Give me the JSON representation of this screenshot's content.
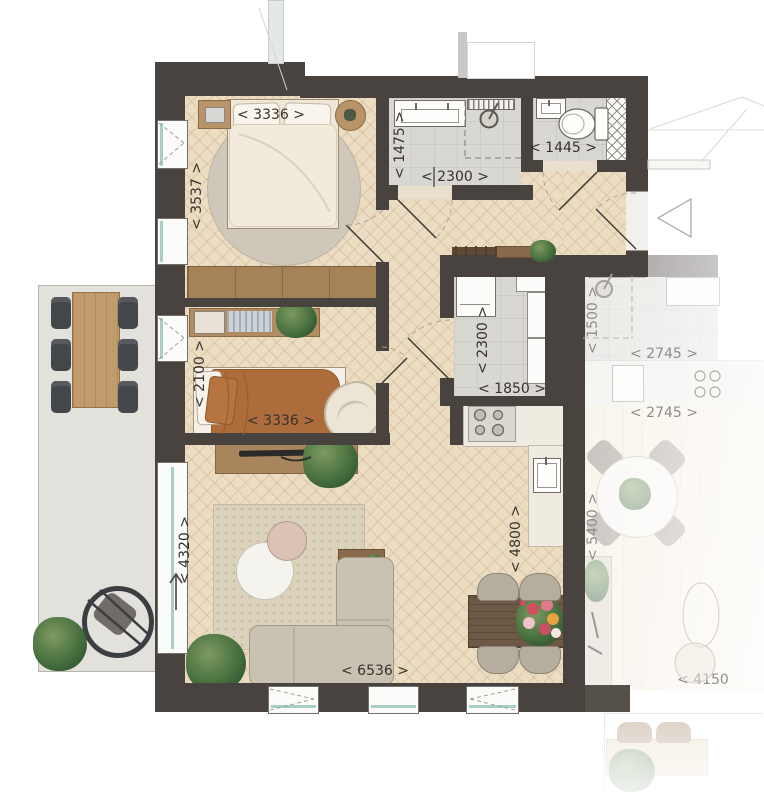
{
  "dimensions_mm": {
    "bedroom1_width": "< 3336 >",
    "bedroom1_depth": "< 3537 >",
    "bathroom_depth": "< 1475 >",
    "bathroom_width": "< 2300 >",
    "wc_width": "< 1445 >",
    "bedroom2_depth": "< 2100 >",
    "bedroom2_width": "< 3336 >",
    "storage_depth": "< 2300 >",
    "storage_width": "< 1850 >",
    "living_depth": "< 4320 >",
    "living_width": "< 6536 >",
    "kitchen_wall_depth": "< 4800 >",
    "neighbor_bathroom_depth": "< 1500 >",
    "neighbor_bathroom_width": "< 2745 >",
    "neighbor_kitchen_width": "< 2745 >",
    "neighbor_living_depth": "< 5400 >",
    "neighbor_living_width": "< 4150"
  },
  "colors": {
    "wall": "#49433f",
    "wood_floor": "#ecdcc2",
    "tile_floor": "#d9d7d2",
    "balcony_floor": "#e2e1dc",
    "window_glass": "#a9cec8",
    "furniture_wood": "#b08a5e"
  }
}
